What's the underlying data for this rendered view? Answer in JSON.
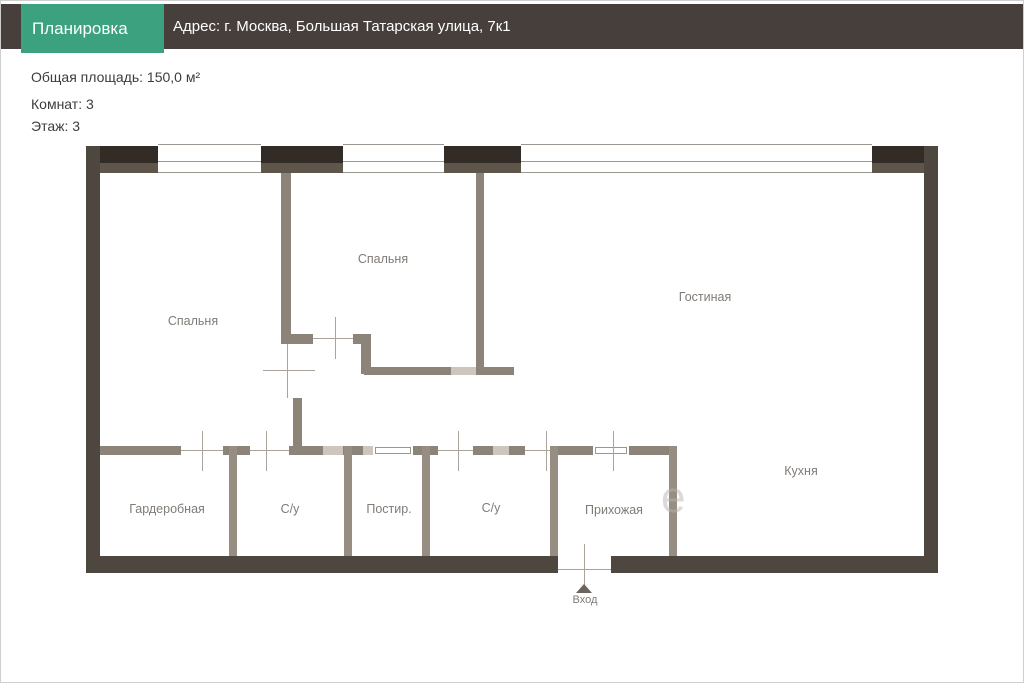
{
  "header": {
    "section_label": "Планировка",
    "address": "Адрес: г. Москва,  Большая Татарская улица, 7к1"
  },
  "info": {
    "total_area": "Общая площадь: 150,0 м²",
    "rooms_count": "Комнат: 3",
    "floor": "Этаж: 3"
  },
  "plan": {
    "rooms": [
      {
        "name": "Спальня"
      },
      {
        "name": "Спальня"
      },
      {
        "name": "Гостиная"
      },
      {
        "name": "Кухня"
      },
      {
        "name": "Гардеробная"
      },
      {
        "name": "С/у"
      },
      {
        "name": "Постир."
      },
      {
        "name": "С/у"
      },
      {
        "name": "Прихожая"
      }
    ],
    "entrance_label": "Вход",
    "watermark_glyph": "е"
  },
  "colors": {
    "accent_green": "#3BA17E",
    "header_bar": "#463F3B",
    "outer_wall": "#4E4740",
    "outer_wall_dark_band": "#332C26",
    "outer_wall_light_band": "#5E564A",
    "interior_wall": "#8C8379",
    "light_wall": "#CCC6BF",
    "room_label_text": "#807B76"
  }
}
